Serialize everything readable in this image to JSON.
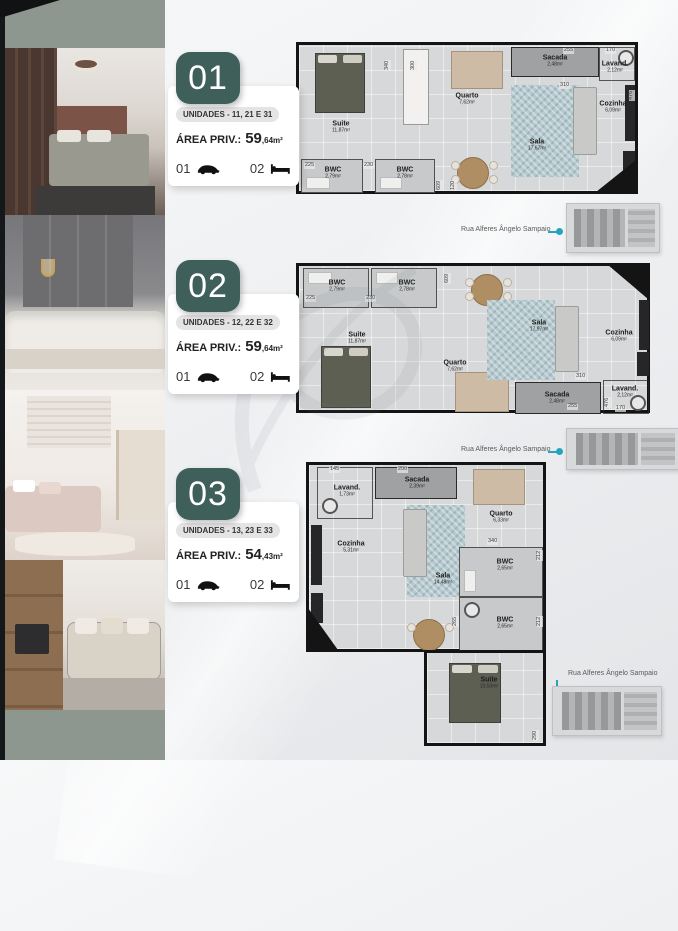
{
  "street_label": "Rua Alferes Ângelo Sampaio",
  "colors": {
    "badge_teal": "#3f5f5b",
    "map_accent": "#27a4bc",
    "wall": "#141414"
  },
  "units": [
    {
      "number": "01",
      "unidades": "UNIDADES - 11, 21 E 31",
      "area_label": "ÁREA PRIV.:",
      "area_main": "59",
      "area_sub": ",64m²",
      "garage": "01",
      "beds": "02"
    },
    {
      "number": "02",
      "unidades": "UNIDADES - 12, 22 E 32",
      "area_label": "ÁREA PRIV.:",
      "area_main": "59",
      "area_sub": ",64m²",
      "garage": "01",
      "beds": "02"
    },
    {
      "number": "03",
      "unidades": "UNIDADES - 13, 23 E 33",
      "area_label": "ÁREA PRIV.:",
      "area_main": "54",
      "area_sub": ",43m²",
      "garage": "01",
      "beds": "02"
    }
  ],
  "plans": [
    {
      "rooms": [
        {
          "name": "Suite",
          "area": "11,87m²"
        },
        {
          "name": "Quarto",
          "area": "7,62m²"
        },
        {
          "name": "Sacada",
          "area": "2,48m²"
        },
        {
          "name": "Lavand.",
          "area": "2,12m²"
        },
        {
          "name": "Cozinha",
          "area": "6,09m²"
        },
        {
          "name": "Sala",
          "area": "17,67m²"
        },
        {
          "name": "BWC",
          "area": "2,79m²"
        },
        {
          "name": "BWC",
          "area": "2,78m²"
        }
      ],
      "dims": [
        "340",
        "300",
        "255",
        "170",
        "310",
        "230",
        "225",
        "609",
        "120",
        "476"
      ]
    },
    {
      "rooms": [
        {
          "name": "BWC",
          "area": "2,79m²"
        },
        {
          "name": "BWC",
          "area": "2,78m²"
        },
        {
          "name": "Suite",
          "area": "11,87m²"
        },
        {
          "name": "Quarto",
          "area": "7,62m²"
        },
        {
          "name": "Sala",
          "area": "17,97m²"
        },
        {
          "name": "Cozinha",
          "area": "6,09m²"
        },
        {
          "name": "Sacada",
          "area": "2,48m²"
        },
        {
          "name": "Lavand.",
          "area": "2,12m²"
        }
      ],
      "dims": [
        "225",
        "230",
        "609",
        "310",
        "255",
        "476",
        "170"
      ]
    },
    {
      "rooms": [
        {
          "name": "Lavand.",
          "area": "1,73m²"
        },
        {
          "name": "Sacada",
          "area": "2,39m²"
        },
        {
          "name": "Quarto",
          "area": "6,33m²"
        },
        {
          "name": "Cozinha",
          "area": "5,31m²"
        },
        {
          "name": "Sala",
          "area": "14,48m²"
        },
        {
          "name": "BWC",
          "area": "2,65m²"
        },
        {
          "name": "BWC",
          "area": "2,65m²"
        },
        {
          "name": "Suite",
          "area": "10,50m²"
        }
      ],
      "dims": [
        "145",
        "200",
        "340",
        "212",
        "265",
        "212",
        "290"
      ]
    }
  ]
}
